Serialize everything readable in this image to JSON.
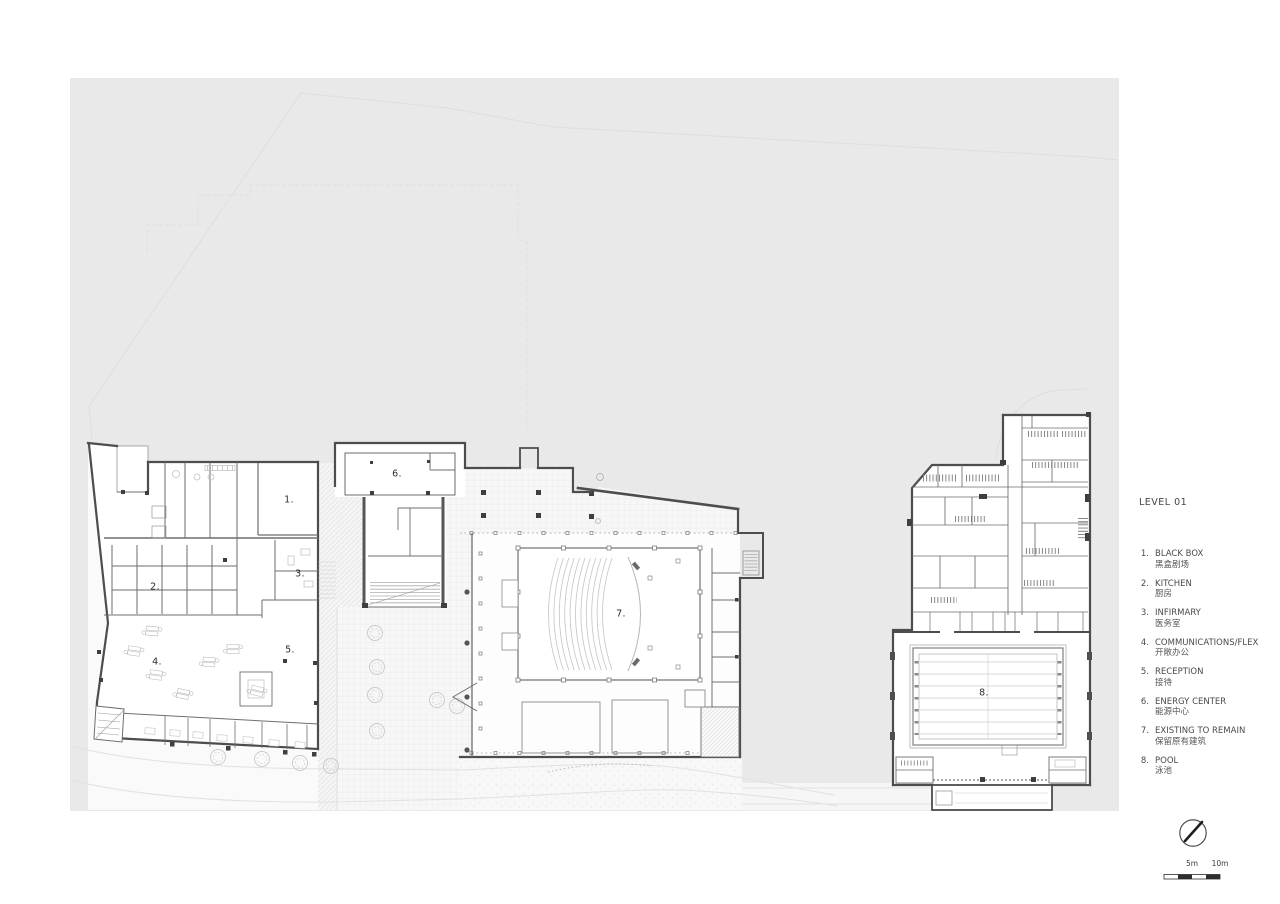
{
  "title": "LEVEL 01",
  "legend": {
    "items": [
      {
        "num": "1.",
        "en": "BLACK BOX",
        "zh": "黑盒剧场"
      },
      {
        "num": "2.",
        "en": "KITCHEN",
        "zh": "厨房"
      },
      {
        "num": "3.",
        "en": "INFIRMARY",
        "zh": "医务室"
      },
      {
        "num": "4.",
        "en": "COMMUNICATIONS/FLEX",
        "zh": "开敞办公"
      },
      {
        "num": "5.",
        "en": "RECEPTION",
        "zh": "接待"
      },
      {
        "num": "6.",
        "en": "ENERGY CENTER",
        "zh": "能源中心"
      },
      {
        "num": "7.",
        "en": "EXISTING TO REMAIN",
        "zh": "保留原有建筑"
      },
      {
        "num": "8.",
        "en": "POOL",
        "zh": "泳池"
      }
    ]
  },
  "plan_labels": [
    "1.",
    "2.",
    "3.",
    "4.",
    "5.",
    "6.",
    "7.",
    "8."
  ],
  "scale_bar": {
    "labels": [
      "5m",
      "10m"
    ]
  },
  "colors": {
    "site_fill": "#e9e9e9",
    "outer_wall": "#4d4d4d",
    "text": "#3c3c3c"
  }
}
